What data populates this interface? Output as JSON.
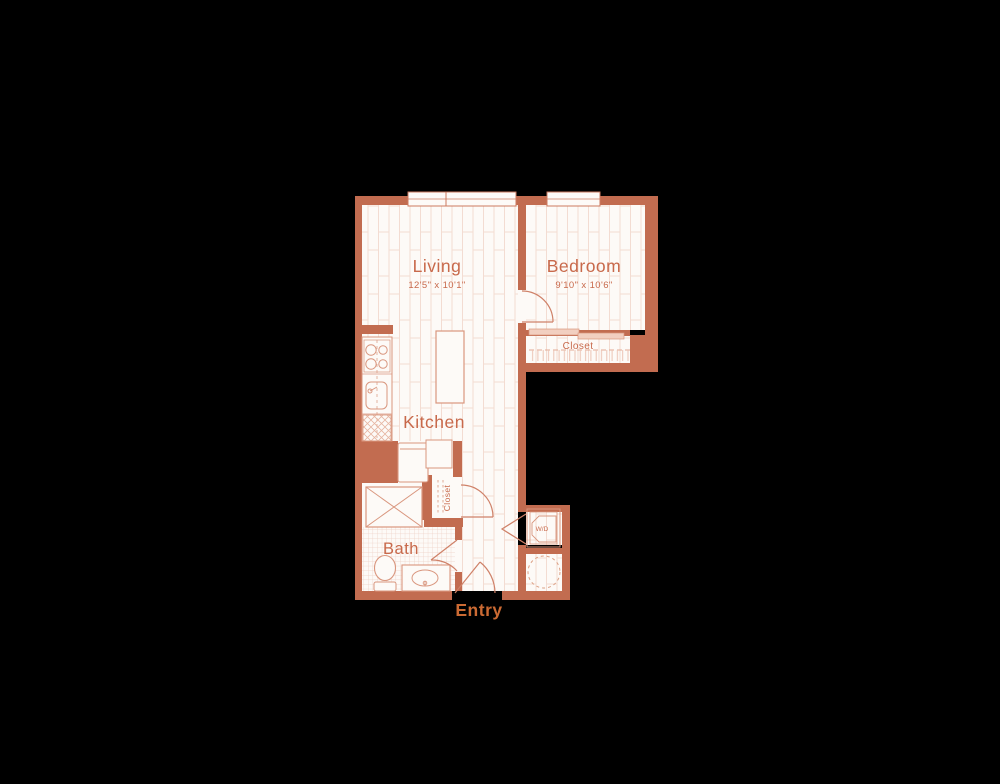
{
  "image": {
    "type": "apartment-floor-plan",
    "background": "#000000"
  },
  "palette": {
    "wall": "#c26c50",
    "floor": "#fdfaf7",
    "plank_line": "#f3dcd2",
    "tile_line": "#edd0c4",
    "fixture_stroke": "#d9967e",
    "door_stroke": "#cf8168",
    "label_text": "#c8694b",
    "entry_text": "#cb6a33",
    "sliding_door_fill": "#f2cfc0"
  },
  "rooms": {
    "living": {
      "label": "Living",
      "dims": "12'5\" x 10'1\""
    },
    "bedroom": {
      "label": "Bedroom",
      "dims": "9'10\" x 10'6\""
    },
    "kitchen": {
      "label": "Kitchen"
    },
    "bath": {
      "label": "Bath"
    },
    "entry": {
      "label": "Entry"
    },
    "bedroom_closet": {
      "label": "Closet"
    },
    "hall_closet": {
      "label": "Closet"
    },
    "laundry": {
      "label": "W/D"
    }
  },
  "fixtures": [
    "stove-burners",
    "kitchen-sink",
    "dishwasher",
    "refrigerator",
    "kitchen-island",
    "cabinet",
    "shower",
    "toilet",
    "vanity-sink",
    "washer-dryer-unit",
    "water-heater",
    "living-window",
    "bedroom-window",
    "sliding-closet-doors",
    "hanger-rod"
  ]
}
